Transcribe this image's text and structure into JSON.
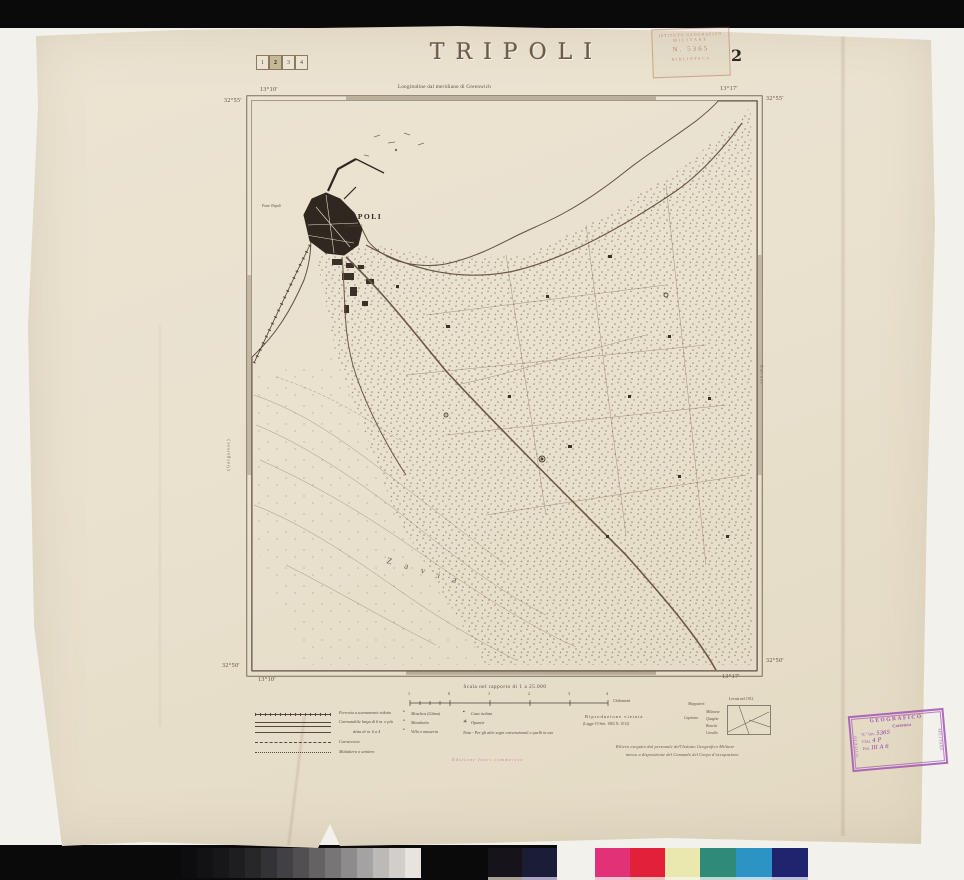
{
  "colors": {
    "paper": "#eae2cf",
    "ink": "#4a4136",
    "map_line": "#5d5040",
    "city_fill": "#2e2821",
    "road": "#6b5744",
    "stamp_purple": "#a253b5",
    "stamp_red": "#a5523f",
    "edition_pink": "#c87f95"
  },
  "header": {
    "title": "TRIPOLI",
    "sheet_number": "2",
    "index_cells": [
      "1",
      "2",
      "3",
      "4"
    ],
    "active_index_cell": "2",
    "meridian_note": "Longitudine dal meridiano di Greenwich"
  },
  "corners": {
    "top_left_lon": "13°10'",
    "top_left_lat": "32°55'",
    "top_right_lon": "13°17'",
    "top_right_lat": "32°55'",
    "bottom_left_lat": "32°50'",
    "bottom_left_lon": "13°10'",
    "bottom_right_lat": "32°50'",
    "bottom_right_lon": "13°17'"
  },
  "map_labels": {
    "city": "TRIPOLI",
    "city_alt": "(Tarabulos)",
    "fort": "Forte Tripoli",
    "district": "Zavia",
    "edge_left": "(Gargaresc)",
    "edge_right": "Amruss"
  },
  "scale_bar": {
    "caption": "Scala nel rapporto di 1 a 25.000",
    "tick_labels": [
      "1",
      "0",
      "1",
      "2",
      "3",
      "4"
    ],
    "unit": "Chilometri"
  },
  "legend": {
    "roads": [
      {
        "label": "Ferrovia a scartamento ridotto",
        "style": "railway"
      },
      {
        "label": "Carrozzabile larga di 6 m. o più",
        "style": "double"
      },
      {
        "label": "detta di m. 6 a 4",
        "style": "single"
      },
      {
        "label": "Carrareccia",
        "style": "dashed"
      },
      {
        "label": "Mulattiera o sentiero",
        "style": "dotted"
      }
    ],
    "symbols": [
      {
        "glyph": "•",
        "label": "Moschea (Gâma)"
      },
      {
        "glyph": "•",
        "label": "Marabutto"
      },
      {
        "glyph": "•",
        "label": "Villa o masseria"
      }
    ],
    "symbols2": [
      {
        "glyph": "▪",
        "label": "Casa isolata"
      },
      {
        "glyph": "✳",
        "label": "Opuntie"
      }
    ],
    "note": "Nota - Per gli altri segni convenzionali e quelli in uso"
  },
  "edition_note": "Edizione fuori commercio",
  "imprint": {
    "reproduction": "Riproduzione vietata",
    "law": "(Legge 19 Sett. 1882 N. 1012)",
    "surveyors_title": "Mappatori:",
    "rank": "Capitano",
    "surveyors": [
      "Milanese",
      "Quaglia",
      "Bonetti",
      "Cavallo"
    ],
    "survey_note": "Levata nel 1912",
    "credit_line1": "Rilievo eseguito dal personale dell'Istituto Geografico Militare",
    "credit_line2": "messo a disposizione del Comando del Corpo d'occupazione"
  },
  "stamps": {
    "library": {
      "top": "ISTITUTO GEOGRAFICO",
      "mid": "MILITARE",
      "number": "N. 5365",
      "bottom": "BIBLIOTECA"
    },
    "cartoteca": {
      "arc": "GEOGRAFICO",
      "left": "ISTITUTO",
      "right": "MILITARE",
      "title": "Cartoteca",
      "inv_label": "N.º Inv.",
      "inv_value": "5365",
      "clas_label": "Clas.",
      "clas_value": "4 P",
      "pos_label": "Pos.",
      "pos_value": "III A 6"
    }
  },
  "calibration": {
    "grayscale": [
      "#0a0a0c",
      "#0d0d0f",
      "#121114",
      "#171619",
      "#1e1d20",
      "#272629",
      "#333236",
      "#424044",
      "#524f52",
      "#656264",
      "#787577",
      "#8e8b8c",
      "#a5a2a2",
      "#bcb9b7",
      "#d2cfcb",
      "#e7e4df"
    ],
    "dark_patches": [
      "#16131a",
      "#1b1c36"
    ],
    "dark_tints": [
      "#a8a297",
      "#aaa6c4"
    ],
    "color_patches": [
      "#e23177",
      "#e3203a",
      "#ebe8af",
      "#2f8a7a",
      "#2c94c4",
      "#20246f"
    ],
    "tint_patches": [
      "#efc4d6",
      "#f0c0c0",
      "#f4f2da",
      "#bfdcd4",
      "#c0dcec",
      "#bfc2dc"
    ]
  }
}
